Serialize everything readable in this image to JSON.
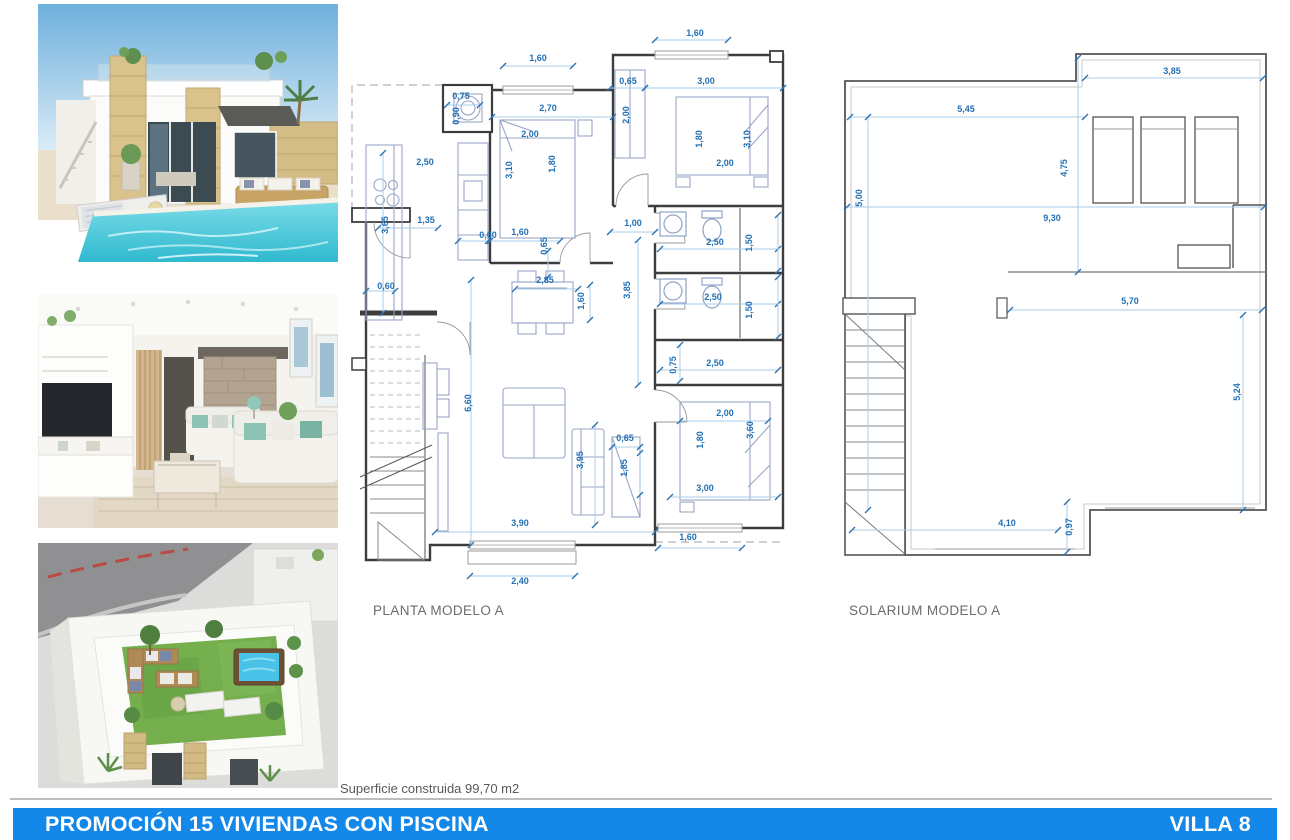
{
  "colors": {
    "dimension_text": "#2270b5",
    "dimension_line": "#a9cbe8",
    "wall": "#3d3d3d",
    "bar_blue": "#1488e9",
    "label_gray": "#6b6b6b",
    "pool_teal": "#45c6d8",
    "lawn_green": "#74ae4d"
  },
  "photos": [
    {
      "name": "villa-exterior-pool-render"
    },
    {
      "name": "living-room-interior-render"
    },
    {
      "name": "rooftop-solarium-aerial-render"
    }
  ],
  "plans": {
    "planta": {
      "label": "PLANTA MODELO A",
      "dimensions": [
        {
          "v": "1,60",
          "x": 345,
          "y": 11,
          "r": 0
        },
        {
          "v": "1,60",
          "x": 188,
          "y": 36,
          "r": 0
        },
        {
          "v": "0,75",
          "x": 111,
          "y": 74,
          "r": 0
        },
        {
          "v": "0,90",
          "x": 109,
          "y": 91,
          "r": -90
        },
        {
          "v": "2,70",
          "x": 198,
          "y": 86,
          "r": 0
        },
        {
          "v": "2,00",
          "x": 180,
          "y": 112,
          "r": 0
        },
        {
          "v": "3,10",
          "x": 162,
          "y": 145,
          "r": -90
        },
        {
          "v": "1,80",
          "x": 205,
          "y": 139,
          "r": -90
        },
        {
          "v": "0,65",
          "x": 278,
          "y": 59,
          "r": 0
        },
        {
          "v": "3,00",
          "x": 356,
          "y": 59,
          "r": 0
        },
        {
          "v": "2,00",
          "x": 279,
          "y": 90,
          "r": -90
        },
        {
          "v": "1,80",
          "x": 352,
          "y": 114,
          "r": -90
        },
        {
          "v": "3,10",
          "x": 400,
          "y": 114,
          "r": -90
        },
        {
          "v": "2,00",
          "x": 375,
          "y": 141,
          "r": 0
        },
        {
          "v": "2,50",
          "x": 75,
          "y": 140,
          "r": 0
        },
        {
          "v": "1,35",
          "x": 76,
          "y": 198,
          "r": 0
        },
        {
          "v": "3,65",
          "x": 38,
          "y": 200,
          "r": -90
        },
        {
          "v": "0,60",
          "x": 138,
          "y": 213,
          "r": 0
        },
        {
          "v": "1,60",
          "x": 170,
          "y": 210,
          "r": 0
        },
        {
          "v": "0,65",
          "x": 197,
          "y": 221,
          "r": -90
        },
        {
          "v": "0,60",
          "x": 36,
          "y": 264,
          "r": 0
        },
        {
          "v": "1,00",
          "x": 283,
          "y": 201,
          "r": 0
        },
        {
          "v": "3,85",
          "x": 280,
          "y": 265,
          "r": -90
        },
        {
          "v": "2,50",
          "x": 365,
          "y": 220,
          "r": 0
        },
        {
          "v": "1,50",
          "x": 402,
          "y": 218,
          "r": -90
        },
        {
          "v": "2,50",
          "x": 363,
          "y": 275,
          "r": 0
        },
        {
          "v": "1,50",
          "x": 402,
          "y": 285,
          "r": -90
        },
        {
          "v": "0,75",
          "x": 326,
          "y": 340,
          "r": -90
        },
        {
          "v": "2,50",
          "x": 365,
          "y": 341,
          "r": 0
        },
        {
          "v": "2,85",
          "x": 195,
          "y": 258,
          "r": 0
        },
        {
          "v": "1,60",
          "x": 234,
          "y": 276,
          "r": -90
        },
        {
          "v": "6,60",
          "x": 121,
          "y": 378,
          "r": -90
        },
        {
          "v": "3,95",
          "x": 233,
          "y": 435,
          "r": -90
        },
        {
          "v": "0,65",
          "x": 275,
          "y": 416,
          "r": 0
        },
        {
          "v": "1,85",
          "x": 277,
          "y": 443,
          "r": -90
        },
        {
          "v": "2,00",
          "x": 375,
          "y": 391,
          "r": 0
        },
        {
          "v": "1,80",
          "x": 353,
          "y": 415,
          "r": -90
        },
        {
          "v": "3,60",
          "x": 403,
          "y": 405,
          "r": -90
        },
        {
          "v": "3,00",
          "x": 355,
          "y": 466,
          "r": 0
        },
        {
          "v": "3,90",
          "x": 170,
          "y": 501,
          "r": 0
        },
        {
          "v": "1,60",
          "x": 338,
          "y": 515,
          "r": 0
        },
        {
          "v": "2,40",
          "x": 170,
          "y": 559,
          "r": 0
        }
      ]
    },
    "solarium": {
      "label": "SOLARIUM MODELO A",
      "dimensions": [
        {
          "v": "3,85",
          "x": 337,
          "y": 34,
          "r": 0
        },
        {
          "v": "5,45",
          "x": 131,
          "y": 72,
          "r": 0
        },
        {
          "v": "4,75",
          "x": 232,
          "y": 128,
          "r": -90
        },
        {
          "v": "5,00",
          "x": 27,
          "y": 158,
          "r": -90
        },
        {
          "v": "9,30",
          "x": 217,
          "y": 181,
          "r": 0
        },
        {
          "v": "5,70",
          "x": 295,
          "y": 264,
          "r": 0
        },
        {
          "v": "5,24",
          "x": 405,
          "y": 352,
          "r": -90
        },
        {
          "v": "4,10",
          "x": 172,
          "y": 486,
          "r": 0
        },
        {
          "v": "0,97",
          "x": 237,
          "y": 487,
          "r": -90
        }
      ]
    }
  },
  "notes": {
    "surface": "Superficie construida 99,70 m2"
  },
  "footer_bar": {
    "title": "PROMOCIÓN 15 VIVIENDAS CON PISCINA",
    "villa": "VILLA 8"
  }
}
